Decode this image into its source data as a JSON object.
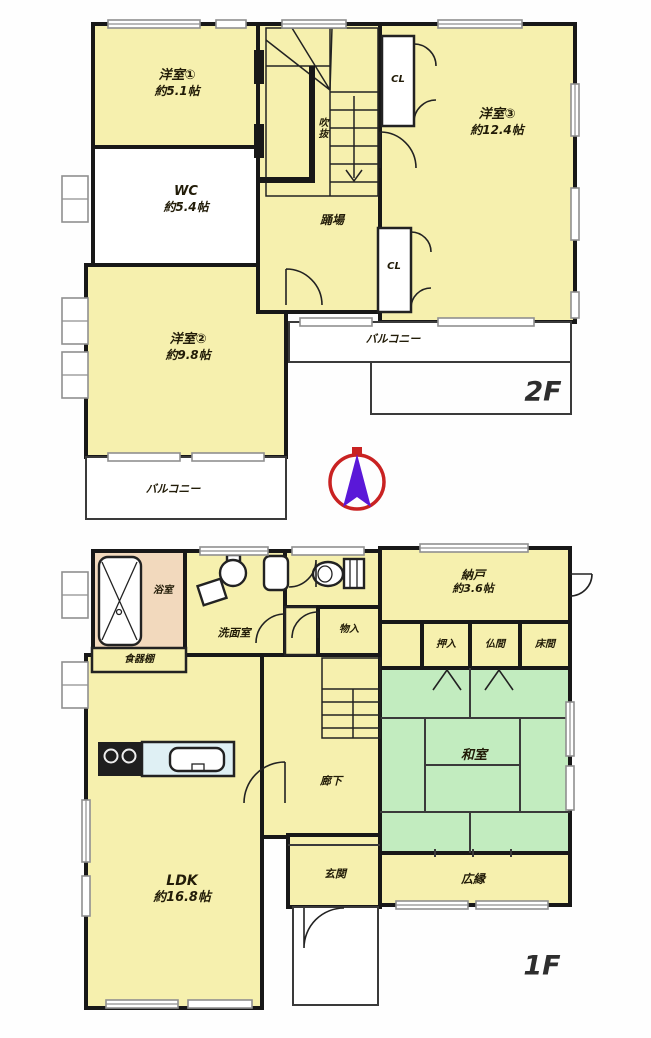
{
  "document": {
    "type": "floor-plan"
  },
  "floors": {
    "f2": {
      "title": "2F",
      "rooms": {
        "yoshitsu1": {
          "name": "洋室①",
          "size": "約5.1帖"
        },
        "wc": {
          "name": "WC",
          "size": "約5.4帖"
        },
        "yoshitsu3": {
          "name": "洋室③",
          "size": "約12.4帖"
        },
        "yoshitsu2": {
          "name": "洋室②",
          "size": "約9.8帖"
        },
        "hall": "踊場",
        "void": "吹抜",
        "cl_top": "CL",
        "cl_bottom": "CL",
        "balcony_right": "バルコニー",
        "balcony_left": "バルコニー"
      }
    },
    "f1": {
      "title": "1F",
      "rooms": {
        "bath": "浴室",
        "washroom": "洗面室",
        "storage_small": "物入",
        "nando": {
          "name": "納戸",
          "size": "約3.6帖"
        },
        "oshiire": "押入",
        "butsuma": "仏間",
        "tokonoma": "床間",
        "washitsu": "和室",
        "hiroen": "広縁",
        "ldk": {
          "name": "LDK",
          "size": "約16.8帖"
        },
        "corridor": "廊下",
        "genkan": "玄関",
        "cupboard": "食器棚"
      }
    }
  },
  "colors": {
    "room_yellow": "#f6f0ae",
    "room_white": "#ffffff",
    "tatami_green": "#c2ecbf",
    "bath_tan": "#f2d9bd",
    "counter_blue": "#dff0f4",
    "wall": "#181818",
    "compass_ring": "#c92222",
    "compass_needle": "#5a18d8"
  }
}
